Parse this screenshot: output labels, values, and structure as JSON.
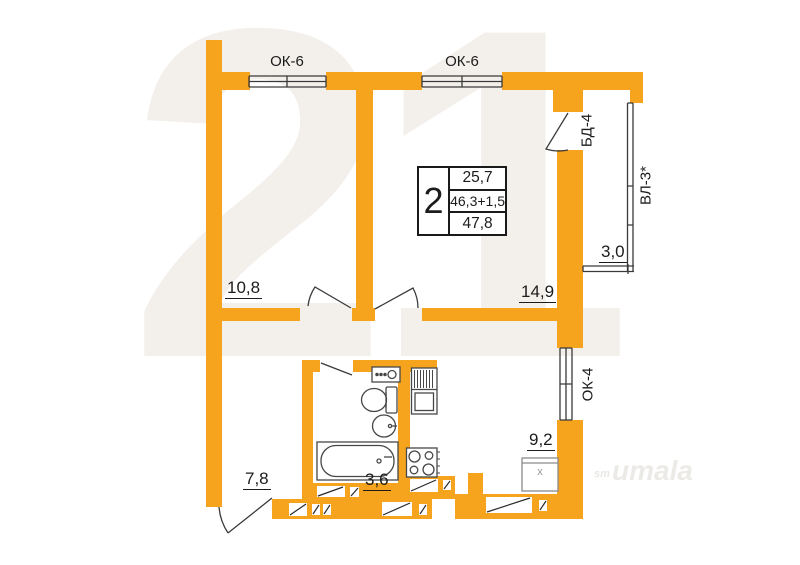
{
  "plan": {
    "info_box": {
      "rooms": "2",
      "row1": "25,7",
      "row2": "46,3+1,5",
      "row3": "47,8"
    },
    "window_labels": {
      "ok6_left": "ОК-6",
      "ok6_right": "ОК-6",
      "ok4": "ОК-4"
    },
    "balcony": {
      "door": "БД-4",
      "glazing": "ВЛ-3*",
      "area": "3,0"
    },
    "room_areas": {
      "bedroom": "10,8",
      "living": "14,9",
      "hallway": "7,8",
      "bathroom": "3,6",
      "kitchen": "9,2"
    },
    "appliance_mark": "х"
  },
  "watermark": {
    "logo": "21",
    "tag_small": "sm",
    "tag": "umala"
  },
  "colors": {
    "wall": "#F6A41D",
    "line": "#3a3a3a",
    "text": "#1c1c1c",
    "watermark": "#f3f0ec"
  }
}
